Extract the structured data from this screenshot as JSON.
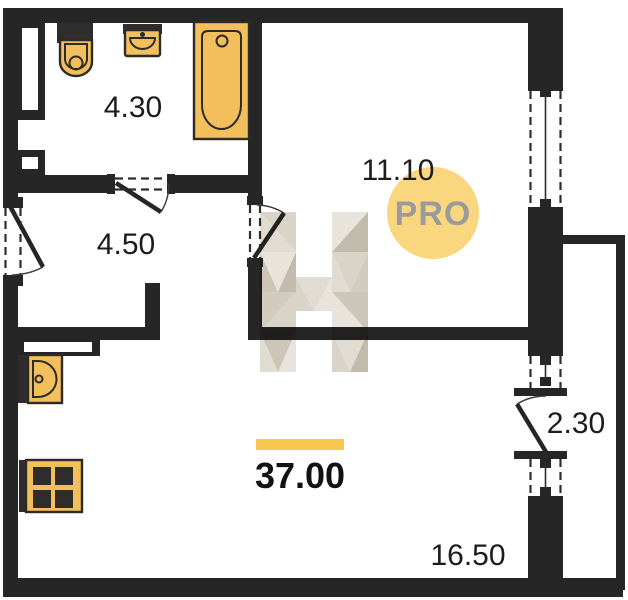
{
  "plan": {
    "rooms": [
      {
        "name": "bathroom",
        "area": "4.30"
      },
      {
        "name": "hallway",
        "area": "4.50"
      },
      {
        "name": "bedroom",
        "area": "11.10"
      },
      {
        "name": "balcony",
        "area": "2.30"
      },
      {
        "name": "kitchen-living-room",
        "area": "16.50"
      }
    ],
    "total_area": "37.00",
    "badge": {
      "label": "PRO"
    },
    "watermark": {
      "letter": "H"
    },
    "fixtures": [
      {
        "name": "toilet"
      },
      {
        "name": "washbasin"
      },
      {
        "name": "bathtub"
      },
      {
        "name": "kitchen-sink"
      },
      {
        "name": "stove"
      }
    ],
    "colors": {
      "wall": "#262626",
      "fixture_fill": "#F3BE5C",
      "fixture_outline": "#2B2B28",
      "badge_circle": "#FAD77E",
      "badge_text": "#9B9B9B",
      "accent_bar": "#F9C74F",
      "label_text": "#1C1C1C",
      "watermark_light": "#E8E3D9",
      "watermark_mid": "#D0C9BB",
      "watermark_dark": "#BFB6A6"
    }
  }
}
